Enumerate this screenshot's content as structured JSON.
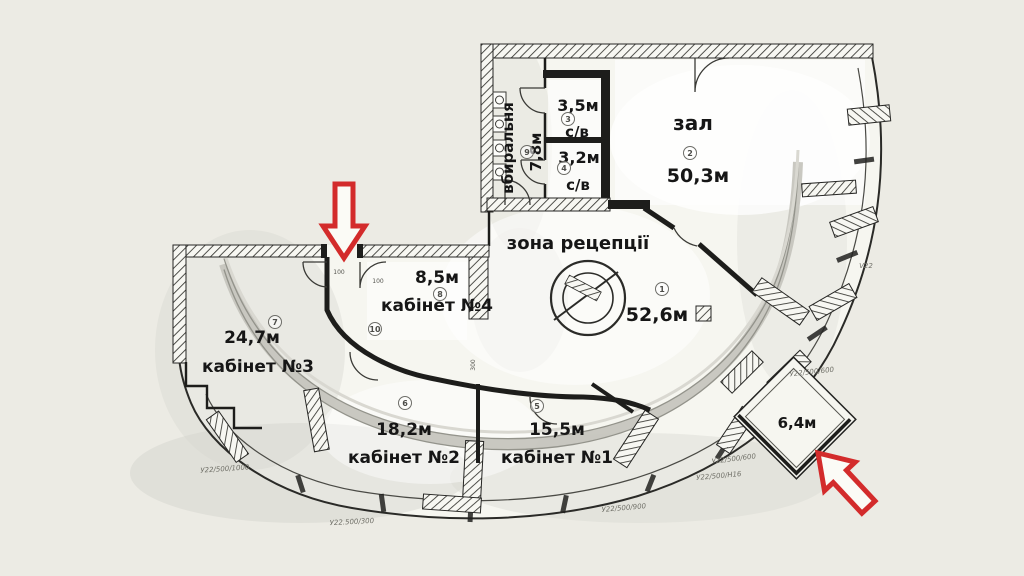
{
  "colors": {
    "background": "#ecebe4",
    "paper": "#f6f6f0",
    "wall": "#1d1d1b",
    "accent_red": "#d32b2b",
    "band_gray": "#c6c5be"
  },
  "rooms": {
    "restroom": {
      "name": "вбиральня",
      "area": "7,8м",
      "num": "9"
    },
    "wc_top": {
      "name": "с/в",
      "area": "3,5м",
      "num": "3"
    },
    "wc_bottom": {
      "name": "с/в",
      "area": "3,2м",
      "num": "4"
    },
    "hall": {
      "name": "зал",
      "area": "50,3м",
      "num": "2"
    },
    "reception": {
      "name": "зона рецепції",
      "area": "52,6м",
      "num": "1"
    },
    "office4": {
      "name": "кабінет №4",
      "area": "8,5м",
      "num": "8"
    },
    "office3": {
      "name": "кабінет №3",
      "area": "24,7м",
      "num": "7"
    },
    "office2": {
      "name": "кабінет №2",
      "area": "18,2м",
      "num": "6"
    },
    "office1": {
      "name": "кабінет №1",
      "area": "15,5м",
      "num": "5"
    },
    "corridor": {
      "num": "10"
    },
    "balcony": {
      "area": "6,4м"
    }
  },
  "annotations": {
    "v22": "V22",
    "spec_600_a": "У22/500/600",
    "spec_600_b": "У22/500/600",
    "spec_h16": "У22/500/Н16",
    "spec_900": "У22/500/900",
    "spec_300": "У22.500/300",
    "spec_1000": "У22/500/1000",
    "dim_100_a": "100",
    "dim_100_b": "100",
    "dim_300": "300"
  }
}
